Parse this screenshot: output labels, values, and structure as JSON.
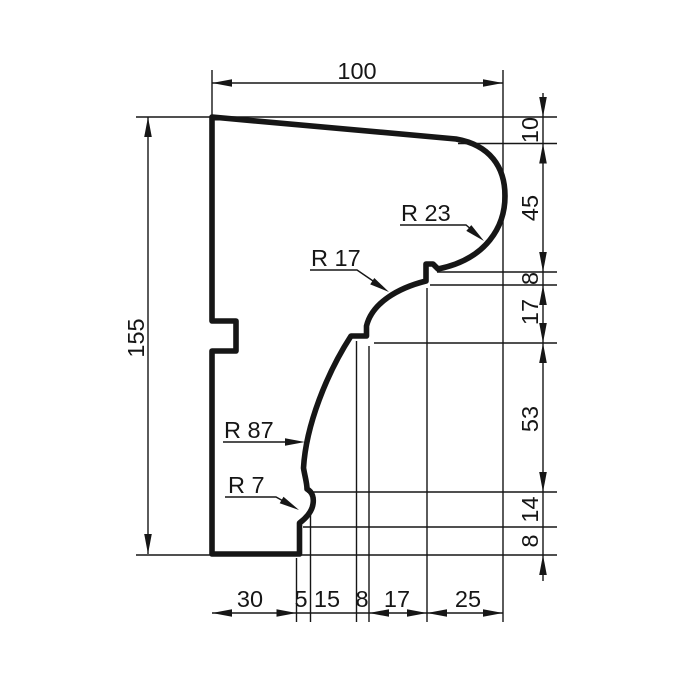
{
  "drawing": {
    "kind": "moulding-profile-section",
    "colors": {
      "line": "#161616",
      "background": "#ffffff"
    }
  },
  "dims": {
    "top": "100",
    "left": "155",
    "right": [
      "10",
      "45",
      "8",
      "17",
      "53",
      "14",
      "8"
    ],
    "bottom": [
      "30",
      "5",
      "15",
      "8",
      "17",
      "25"
    ]
  },
  "radii": [
    "R 23",
    "R 17",
    "R 87",
    "R 7"
  ]
}
